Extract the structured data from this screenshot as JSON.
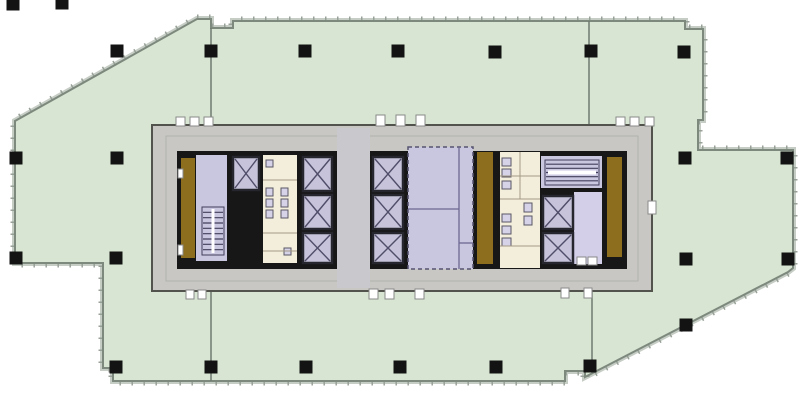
{
  "canvas": {
    "w": 800,
    "h": 400,
    "bg": "#ffffff"
  },
  "palette": {
    "floor": "#d7e5d2",
    "floor_stroke": "#7e897e",
    "outer_band": "#c6cdc5",
    "tick": "#97a197",
    "column": "#131313",
    "demising": "#6f7a6f",
    "ring": "#c8c7c3",
    "ring_stroke": "#52534c",
    "ring_inner_stroke": "#b1b1ad",
    "slab": "#171717",
    "lavender": "#c9c6e0",
    "lav_lobby": "#d3cfe8",
    "cream": "#f3eedb",
    "gold": "#8c6e1e",
    "lobby": "#c9c8cc",
    "car_fill": "#c6c3da",
    "car_stroke": "#26262e",
    "x_stroke": "#504d6a",
    "hatch": "#413f5a",
    "fixture_fill": "#d6d2e8",
    "fixture_stroke": "#5a5766",
    "partition": "#6b6890",
    "partition_soft": "#a49a84",
    "machine_stroke": "#56546f",
    "notch_fill": "#ffffff",
    "notch_stroke": "#8a8a8a"
  },
  "floor_outline": {
    "points": [
      [
        197,
        19
      ],
      [
        211,
        19
      ],
      [
        211,
        28
      ],
      [
        233,
        28
      ],
      [
        233,
        21
      ],
      [
        685,
        21
      ],
      [
        685,
        29
      ],
      [
        703,
        29
      ],
      [
        703,
        120
      ],
      [
        698,
        120
      ],
      [
        698,
        150
      ],
      [
        793,
        150
      ],
      [
        793,
        268
      ],
      [
        788,
        272
      ],
      [
        585,
        377
      ],
      [
        585,
        371
      ],
      [
        565,
        371
      ],
      [
        565,
        381
      ],
      [
        113,
        381
      ],
      [
        113,
        368
      ],
      [
        103,
        368
      ],
      [
        103,
        263
      ],
      [
        15,
        263
      ],
      [
        15,
        121
      ]
    ]
  },
  "demising_walls": [
    {
      "x1": 211,
      "y1": 28,
      "x2": 211,
      "y2": 126
    },
    {
      "x1": 211,
      "y1": 290,
      "x2": 211,
      "y2": 381
    },
    {
      "x1": 589,
      "y1": 21,
      "x2": 589,
      "y2": 126
    },
    {
      "x1": 592,
      "y1": 290,
      "x2": 592,
      "y2": 371
    }
  ],
  "columns": {
    "size": 13,
    "positions": [
      [
        13,
        4
      ],
      [
        62,
        3
      ],
      [
        117,
        51
      ],
      [
        211,
        51
      ],
      [
        305,
        51
      ],
      [
        398,
        51
      ],
      [
        495,
        52
      ],
      [
        591,
        51
      ],
      [
        684,
        52
      ],
      [
        16,
        158
      ],
      [
        117,
        158
      ],
      [
        685,
        158
      ],
      [
        787,
        158
      ],
      [
        16,
        258
      ],
      [
        116,
        258
      ],
      [
        686,
        259
      ],
      [
        788,
        259
      ],
      [
        686,
        325
      ],
      [
        116,
        367
      ],
      [
        211,
        367
      ],
      [
        306,
        367
      ],
      [
        400,
        367
      ],
      [
        496,
        367
      ],
      [
        590,
        366
      ]
    ]
  },
  "core": {
    "outer": {
      "x": 152,
      "y": 125,
      "w": 500,
      "h": 166
    },
    "inner_line": {
      "x": 166,
      "y": 136,
      "w": 472,
      "h": 145
    },
    "slab": {
      "x": 177,
      "y": 151,
      "w": 450,
      "h": 118
    }
  },
  "rooms": [
    {
      "name": "gold-strip-left",
      "x": 181,
      "y": 158,
      "w": 14,
      "h": 100,
      "fill": "gold"
    },
    {
      "name": "stair-room-left",
      "x": 196,
      "y": 155,
      "w": 31,
      "h": 106,
      "fill": "lavender"
    },
    {
      "name": "restroom-left",
      "x": 263,
      "y": 155,
      "w": 34,
      "h": 108,
      "fill": "cream"
    },
    {
      "name": "elevator-lobby-center",
      "x": 337,
      "y": 128,
      "w": 33,
      "h": 160,
      "fill": "lobby"
    },
    {
      "name": "machine-room",
      "x": 408,
      "y": 147,
      "w": 65,
      "h": 122,
      "fill": "lavender",
      "dashed": true
    },
    {
      "name": "gold-strip-mid",
      "x": 477,
      "y": 152,
      "w": 16,
      "h": 112,
      "fill": "gold"
    },
    {
      "name": "restroom-right",
      "x": 500,
      "y": 152,
      "w": 40,
      "h": 116,
      "fill": "cream"
    },
    {
      "name": "stair-room-right",
      "x": 541,
      "y": 156,
      "w": 61,
      "h": 32,
      "fill": "lavender"
    },
    {
      "name": "elevator-lobby-right",
      "x": 574,
      "y": 192,
      "w": 28,
      "h": 72,
      "fill": "lav_lobby"
    },
    {
      "name": "gold-strip-right",
      "x": 607,
      "y": 157,
      "w": 15,
      "h": 100,
      "fill": "gold"
    }
  ],
  "elevator_cars": [
    {
      "x": 233,
      "y": 157,
      "w": 26,
      "h": 33
    },
    {
      "x": 303,
      "y": 157,
      "w": 29,
      "h": 34
    },
    {
      "x": 303,
      "y": 195,
      "w": 29,
      "h": 34
    },
    {
      "x": 303,
      "y": 233,
      "w": 29,
      "h": 30
    },
    {
      "x": 373,
      "y": 157,
      "w": 30,
      "h": 34
    },
    {
      "x": 373,
      "y": 195,
      "w": 30,
      "h": 34
    },
    {
      "x": 373,
      "y": 233,
      "w": 30,
      "h": 30
    },
    {
      "x": 543,
      "y": 196,
      "w": 30,
      "h": 33
    },
    {
      "x": 543,
      "y": 233,
      "w": 30,
      "h": 30
    }
  ],
  "stair_hatches": [
    {
      "name": "stair-flight-left",
      "x": 202,
      "y": 207,
      "w": 22,
      "h": 48,
      "lines": 8,
      "mid": "v"
    },
    {
      "name": "stair-flight-right",
      "x": 545,
      "y": 160,
      "w": 54,
      "h": 25,
      "lines": 5,
      "mid": "h"
    }
  ],
  "fixtures": [
    [
      266,
      188,
      7,
      8
    ],
    [
      281,
      188,
      7,
      8
    ],
    [
      266,
      199,
      7,
      8
    ],
    [
      281,
      199,
      7,
      8
    ],
    [
      266,
      210,
      7,
      8
    ],
    [
      281,
      210,
      7,
      8
    ],
    [
      266,
      160,
      7,
      7
    ],
    [
      284,
      248,
      7,
      7
    ],
    [
      502,
      158,
      9,
      8
    ],
    [
      502,
      169,
      9,
      8
    ],
    [
      502,
      181,
      9,
      8
    ],
    [
      502,
      214,
      9,
      8
    ],
    [
      502,
      226,
      9,
      8
    ],
    [
      502,
      238,
      9,
      8
    ],
    [
      524,
      203,
      8,
      9
    ],
    [
      524,
      216,
      8,
      9
    ]
  ],
  "partitions_soft": [
    [
      263,
      180,
      297,
      180
    ],
    [
      263,
      233,
      297,
      233
    ],
    [
      263,
      251,
      297,
      251
    ],
    [
      500,
      176,
      540,
      176
    ],
    [
      500,
      199,
      540,
      199
    ],
    [
      500,
      246,
      540,
      246
    ],
    [
      520,
      152,
      520,
      199
    ]
  ],
  "partitions_hard": [
    [
      408,
      209,
      459,
      209
    ],
    [
      459,
      147,
      459,
      269
    ],
    [
      459,
      243,
      473,
      243
    ]
  ],
  "door_notches": [
    [
      176,
      117,
      9,
      9
    ],
    [
      190,
      117,
      9,
      9
    ],
    [
      204,
      117,
      9,
      9
    ],
    [
      376,
      115,
      9,
      11
    ],
    [
      396,
      115,
      9,
      11
    ],
    [
      416,
      115,
      9,
      11
    ],
    [
      616,
      117,
      9,
      9
    ],
    [
      630,
      117,
      9,
      9
    ],
    [
      645,
      117,
      9,
      9
    ],
    [
      186,
      290,
      8,
      9
    ],
    [
      198,
      290,
      8,
      9
    ],
    [
      369,
      289,
      9,
      10
    ],
    [
      385,
      289,
      9,
      10
    ],
    [
      415,
      289,
      9,
      10
    ],
    [
      561,
      288,
      8,
      10
    ],
    [
      584,
      288,
      8,
      10
    ],
    [
      648,
      201,
      8,
      13
    ],
    [
      577,
      257,
      9,
      8
    ],
    [
      588,
      257,
      9,
      8
    ],
    [
      178,
      169,
      5,
      9
    ],
    [
      178,
      245,
      5,
      10
    ]
  ]
}
